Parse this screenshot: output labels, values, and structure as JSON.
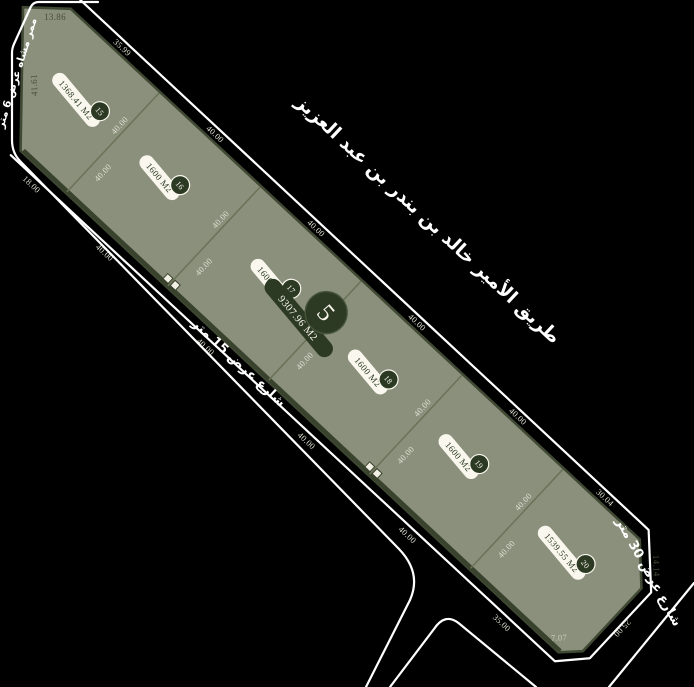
{
  "map_title": "Block 5 subdivision plat",
  "colors": {
    "background": "#000000",
    "land_fill": "#8B907C",
    "land_border": "#3F4933",
    "divider_line": "#6A7258",
    "badge_dark_green": "#2C3A24",
    "pill_cream": "#FAF8EE",
    "street_line_white": "#FFFFFF"
  },
  "block": {
    "number": "5",
    "total_area": "9307.96 M2"
  },
  "parcels": [
    {
      "number": "15",
      "area": "1368.41 M2"
    },
    {
      "number": "16",
      "area": "1600 M2"
    },
    {
      "number": "17",
      "area": "1600 M2"
    },
    {
      "number": "18",
      "area": "1600 M2"
    },
    {
      "number": "19",
      "area": "1600 M2"
    },
    {
      "number": "20",
      "area": "1539.55 M2"
    }
  ],
  "streets": {
    "north_road": "طريق الأمير خالد بن بندر بن عبد العزيز",
    "southwest_street": "شارع عرض 15 متر",
    "southeast_street": "شارع عرض 30 متر",
    "pedestrian_path": "ممر مشاه عرض 6 متر"
  },
  "dimensions": {
    "top_left_edge": "13.86",
    "west_edge": "41.61",
    "top": [
      "35.99",
      "40.00",
      "40.00",
      "40.00",
      "40.00",
      "30.04"
    ],
    "bottom": [
      "18.00",
      "40.00",
      "40.00",
      "40.00",
      "40.00",
      "35.00"
    ],
    "divider_length": "40.00",
    "northeast_chamfer": "14.14",
    "east_edge": "25.00",
    "south_chamfer": "7.07"
  }
}
